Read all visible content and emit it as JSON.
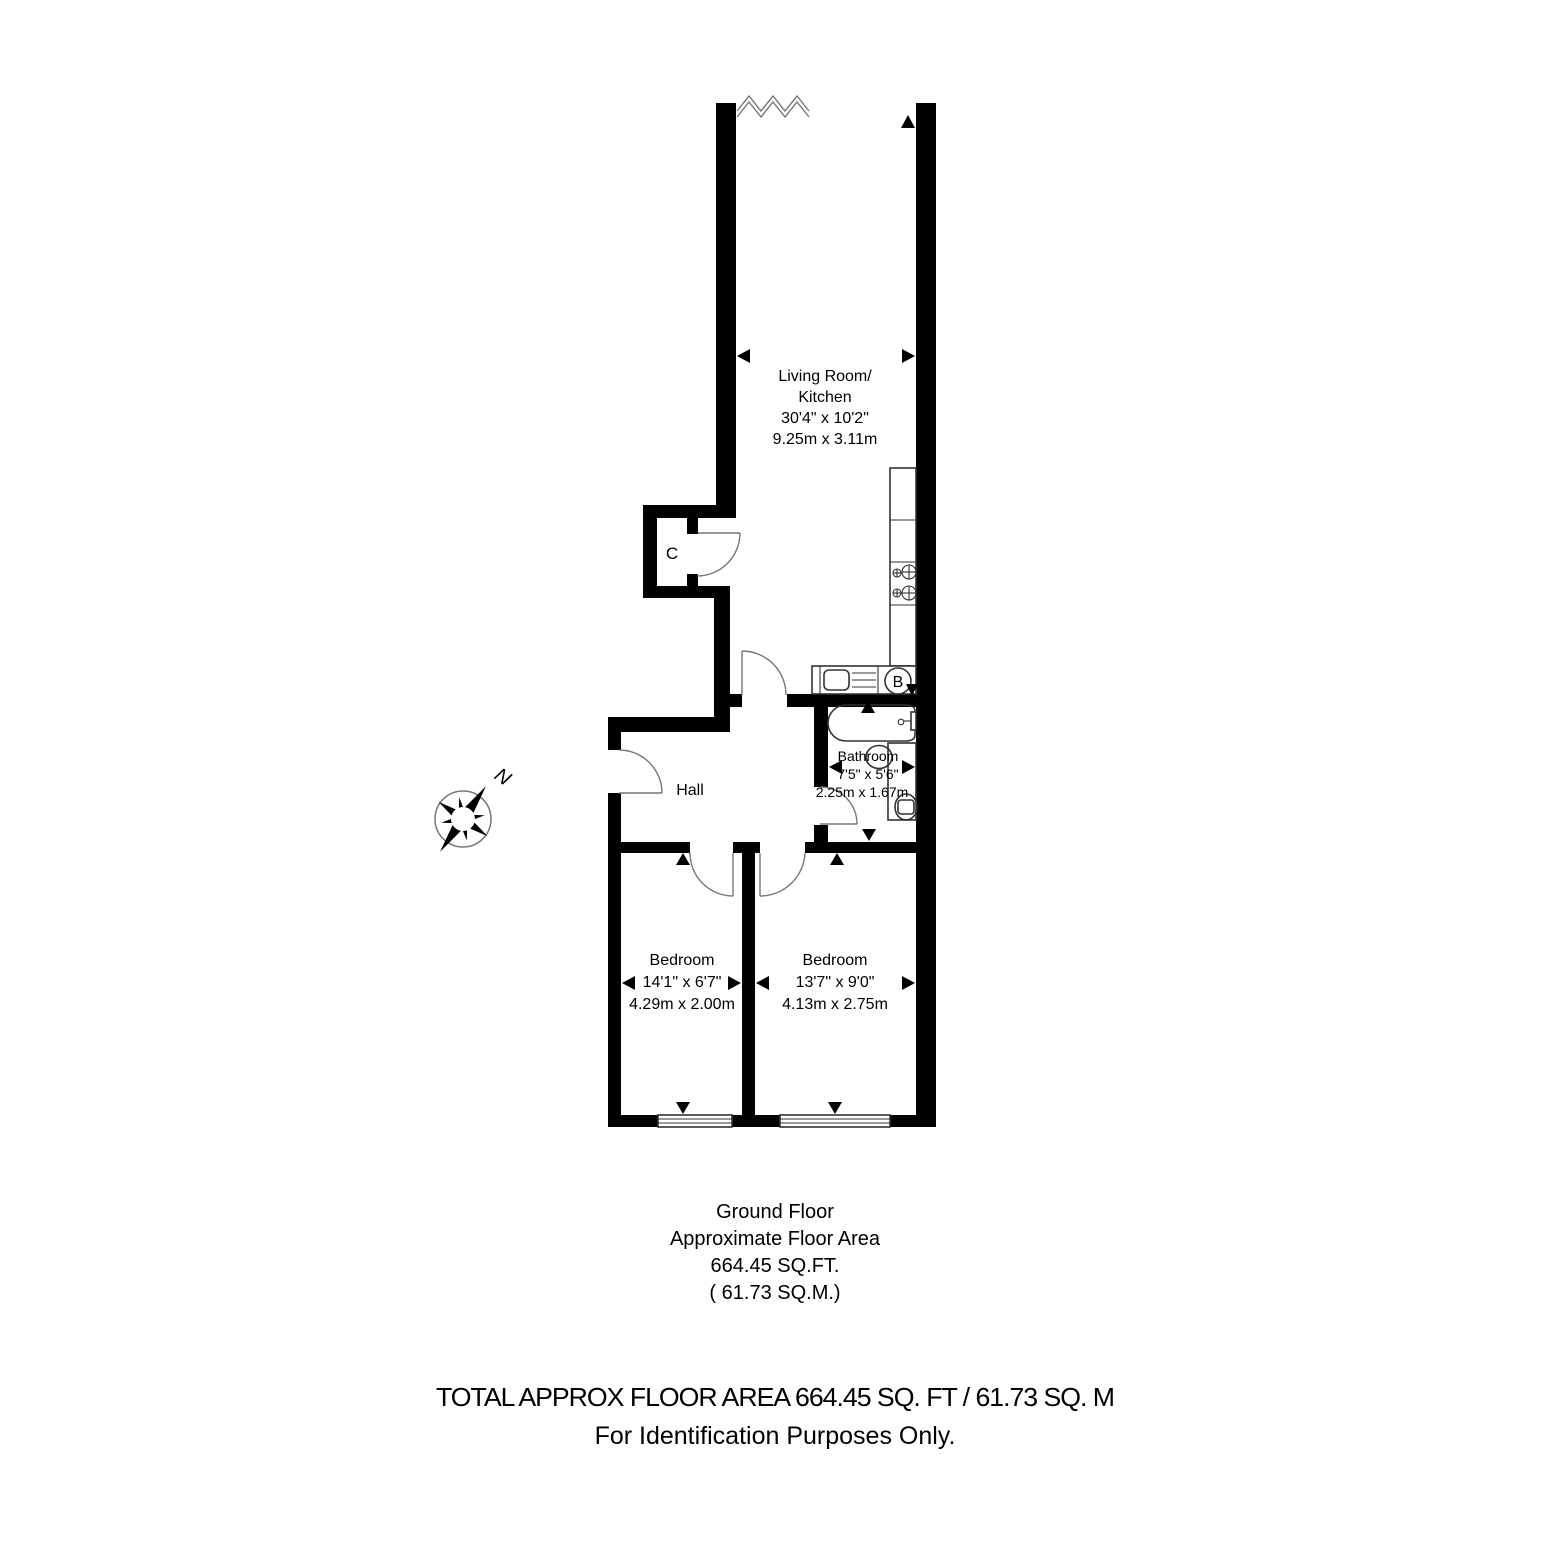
{
  "compass": {
    "label": "N"
  },
  "rooms": {
    "living": {
      "lines": [
        "Living Room/",
        "Kitchen",
        "30'4\" x 10'2\"",
        "9.25m x 3.11m"
      ]
    },
    "hall": {
      "label": "Hall"
    },
    "closet": {
      "label": "C"
    },
    "boiler": {
      "label": "B"
    },
    "bathroom": {
      "lines": [
        "Bathroom",
        "7'5\" x 5'6\"",
        "2.25m x 1.67m"
      ]
    },
    "bedroom1": {
      "lines": [
        "Bedroom",
        "14'1\" x 6'7\"",
        "4.29m x 2.00m"
      ]
    },
    "bedroom2": {
      "lines": [
        "Bedroom",
        "13'7\" x 9'0\"",
        "4.13m x 2.75m"
      ]
    }
  },
  "footer": {
    "floor_label": [
      "Ground Floor",
      "Approximate Floor Area",
      "664.45 SQ.FT.",
      "( 61.73 SQ.M.)"
    ],
    "total_line": "TOTAL APPROX FLOOR AREA 664.45 SQ. FT / 61.73 SQ. M",
    "identification_line": "For Identification Purposes Only."
  }
}
